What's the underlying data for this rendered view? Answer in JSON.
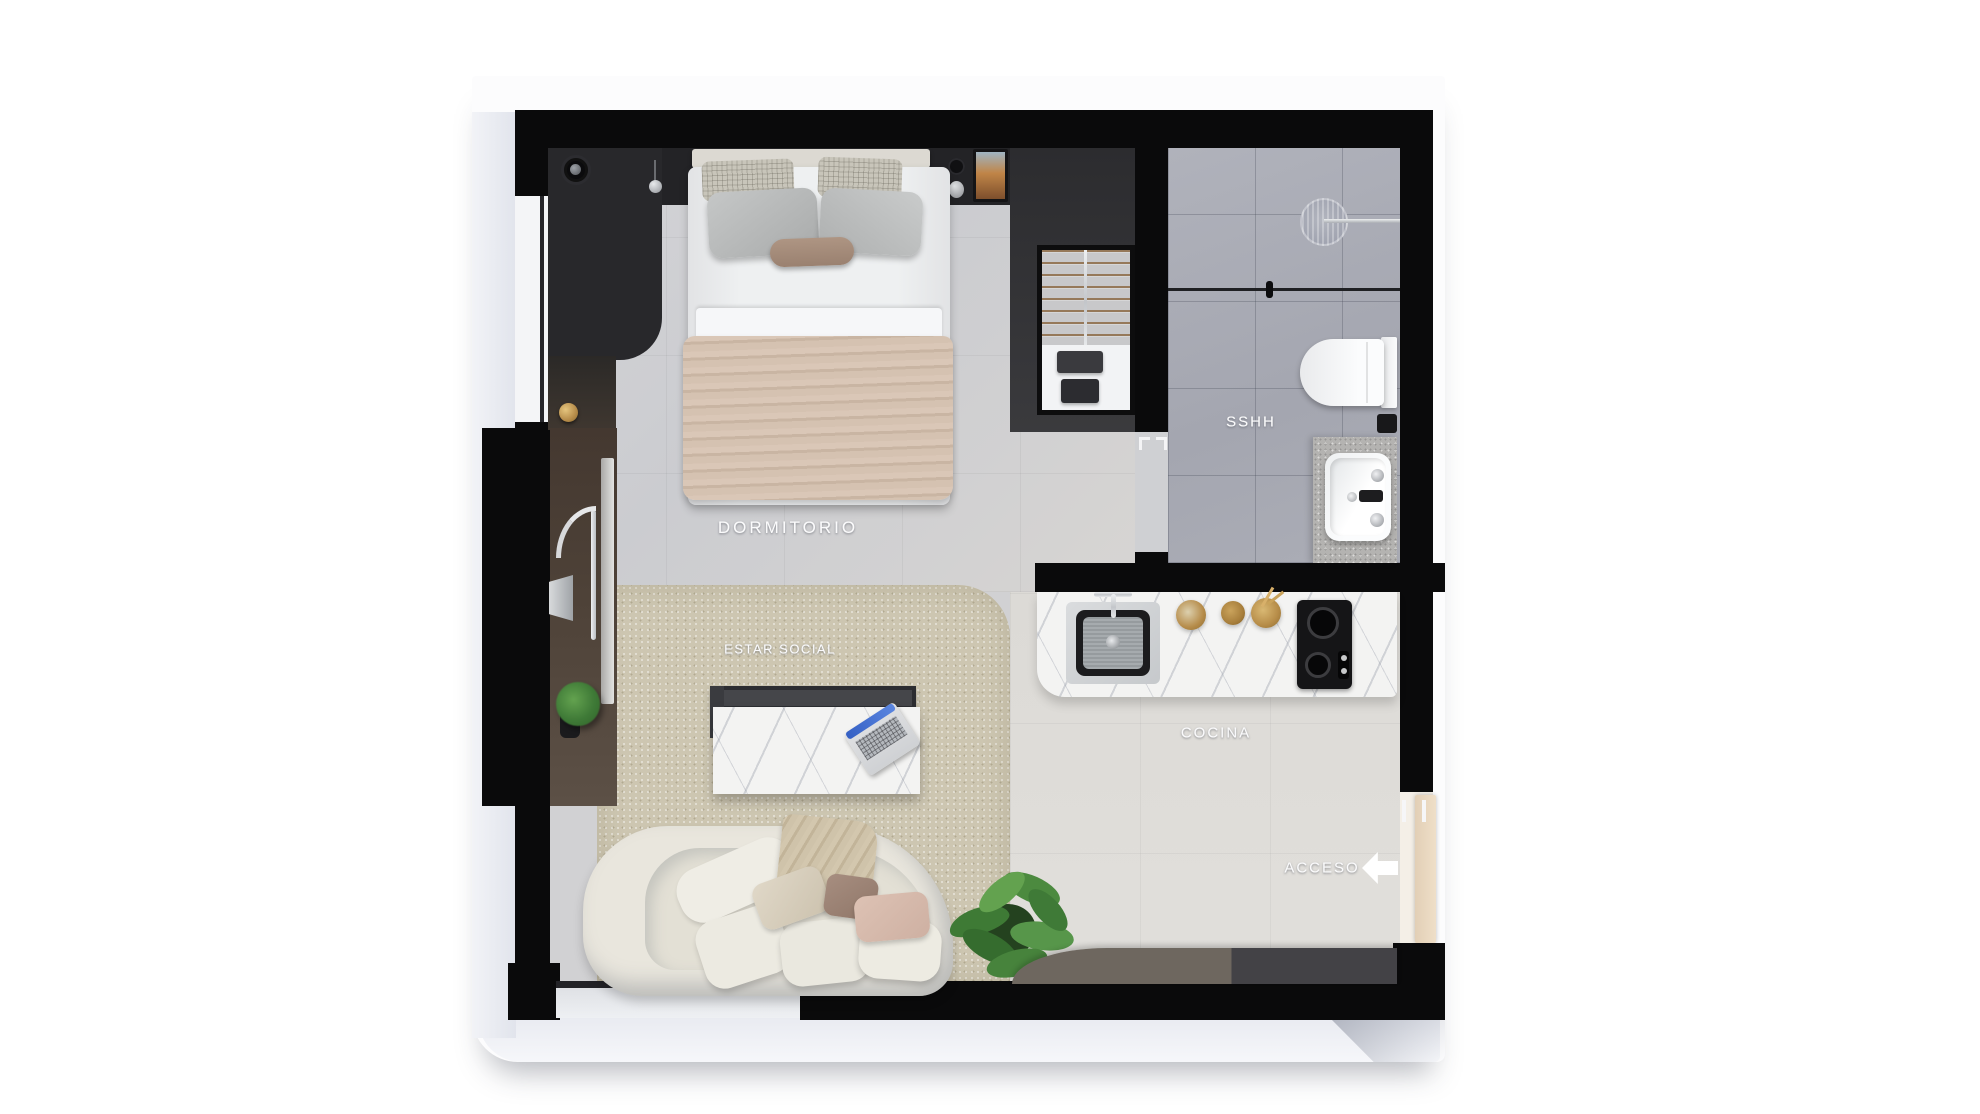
{
  "plan": {
    "type": "apartment floor plan (top-down 3D render)",
    "rooms": [
      {
        "id": "dormitorio",
        "label": "DORMITORIO"
      },
      {
        "id": "estar-social",
        "label": "ESTAR SOCIAL"
      },
      {
        "id": "sshh",
        "label": "SSHH"
      },
      {
        "id": "cocina",
        "label": "COCINA"
      }
    ],
    "labels": {
      "bedroom": "DORMITORIO",
      "living": "ESTAR SOCIAL",
      "bathroom": "SSHH",
      "kitchen": "COCINA",
      "entrance": "ACCESO"
    },
    "entrance": {
      "label": "ACCESO",
      "icon": "left-arrow-icon",
      "arrow_direction": "left"
    }
  },
  "palette": {
    "page_background": "#ffffff",
    "wall_black": "#0a0a0b",
    "bedroom_floor": "#cfcfd2",
    "kitchen_floor": "#dcdad6",
    "bathroom_floor": "#a8aab3",
    "rug_beige": "#cdc6b1",
    "marble_white": "#f3f3f2",
    "blanket_beige": "#d5c2b2",
    "sofa_cream": "#e9e6dd",
    "wood_brown_panel": "#4e4238",
    "accent_gold": "#b68c4a",
    "door_leaf_tan": "#ead9c2",
    "plant_green": "#47833c",
    "label_white": "#fbfbfc"
  }
}
